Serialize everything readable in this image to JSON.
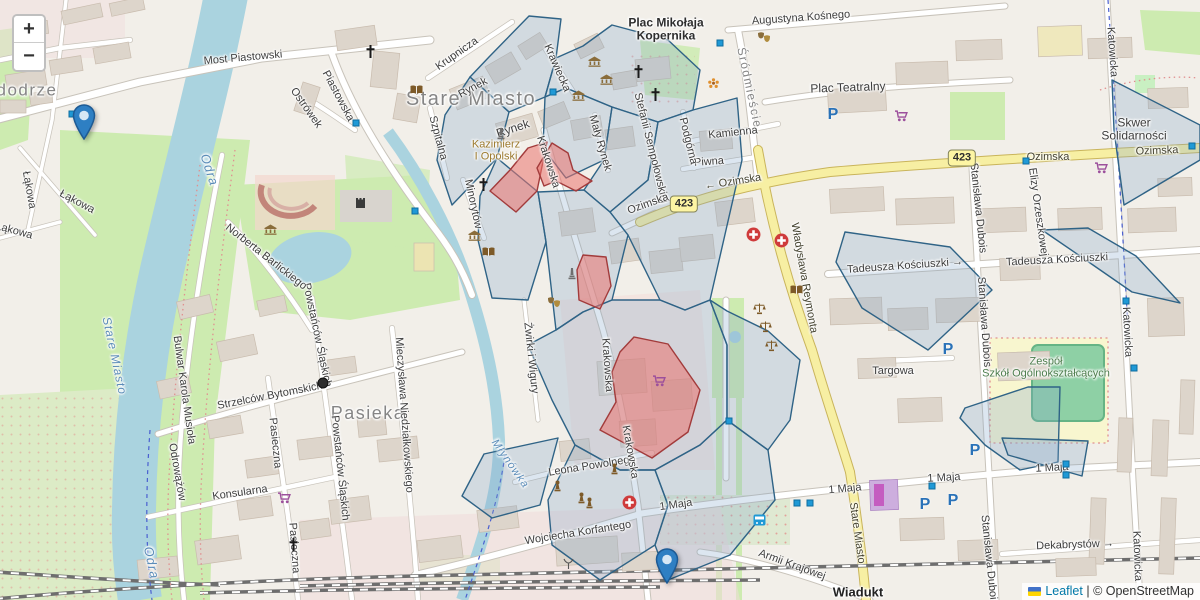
{
  "controls": {
    "zoom_in": "+",
    "zoom_out": "−"
  },
  "attribution": {
    "leaflet": "Leaflet",
    "separator": " | ",
    "copyright": "© OpenStreetMap"
  },
  "glyphs": {
    "parking": "P"
  },
  "colors": {
    "land": "#f2efe9",
    "water": "#aad3df",
    "green": "#cdebb0",
    "building": "#ddd5cb",
    "road_major": "#f7efa3",
    "overlay_blue_stroke": "#2f6386",
    "overlay_blue_fill": "rgba(130,165,200,0.28)",
    "overlay_red_stroke": "#a23b3b",
    "overlay_red_fill": "rgba(235,115,110,0.55)",
    "marker_blue": "#2e7fc3",
    "leaflet_link": "#0078a8"
  },
  "badges": [
    {
      "t": "423",
      "x": 684,
      "y": 204
    },
    {
      "t": "423",
      "x": 962,
      "y": 158
    }
  ],
  "labels": [
    {
      "t": "dodrze",
      "x": 27,
      "y": 90,
      "r": 0,
      "cls": "district",
      "fs": 17
    },
    {
      "t": "Most Piastowski",
      "x": 243,
      "y": 58,
      "r": -5
    },
    {
      "t": "Piastowska",
      "x": 338,
      "y": 96,
      "r": 62
    },
    {
      "t": "Ostrówek",
      "x": 306,
      "y": 108,
      "r": 55
    },
    {
      "t": "Odra",
      "x": 209,
      "y": 170,
      "r": 72,
      "cls": "water",
      "fs": 13
    },
    {
      "t": "Odra",
      "x": 151,
      "y": 563,
      "r": 78,
      "cls": "water",
      "fs": 13
    },
    {
      "t": "Stare Miasto",
      "x": 471,
      "y": 99,
      "r": 0,
      "cls": "district",
      "fs": 20
    },
    {
      "t": "Stare Miasto",
      "x": 114,
      "y": 356,
      "r": 78,
      "cls": "water",
      "fs": 12
    },
    {
      "t": "Krupnicza",
      "x": 457,
      "y": 54,
      "r": -35
    },
    {
      "t": "Rynek",
      "x": 473,
      "y": 88,
      "r": -28
    },
    {
      "t": "Rynek",
      "x": 513,
      "y": 129,
      "r": -18,
      "fs": 12
    },
    {
      "t": "Szpitalna",
      "x": 438,
      "y": 138,
      "r": 75
    },
    {
      "t": "Kazimierz\nI Opolski",
      "x": 496,
      "y": 151,
      "r": 0,
      "cls": "gold"
    },
    {
      "t": "Krawiecka",
      "x": 557,
      "y": 68,
      "r": 66
    },
    {
      "t": "Mały Rynek",
      "x": 600,
      "y": 143,
      "r": 74
    },
    {
      "t": "Stefanii Sempołowskiej",
      "x": 651,
      "y": 148,
      "r": 76
    },
    {
      "t": "Plac Mikołaja\nKopernika",
      "x": 666,
      "y": 30,
      "r": 0,
      "cls": "place",
      "fs": 12
    },
    {
      "t": "Śródmieście",
      "x": 749,
      "y": 88,
      "r": 78,
      "cls": "district",
      "fs": 12
    },
    {
      "t": "Augustyna Kośnego",
      "x": 801,
      "y": 18,
      "r": -4
    },
    {
      "t": "Plac Teatralny",
      "x": 848,
      "y": 88,
      "r": -2,
      "fs": 12
    },
    {
      "t": "Kamienna",
      "x": 733,
      "y": 133,
      "r": -6
    },
    {
      "t": "Piwna",
      "x": 709,
      "y": 162,
      "r": -4
    },
    {
      "t": "Podgórna",
      "x": 688,
      "y": 141,
      "r": 76
    },
    {
      "t": "← Ozimska",
      "x": 733,
      "y": 182,
      "r": -9,
      "cls": "road"
    },
    {
      "t": "Ozimska",
      "x": 648,
      "y": 204,
      "r": -20
    },
    {
      "t": "Ozimska",
      "x": 1048,
      "y": 157,
      "r": 0,
      "cls": "road"
    },
    {
      "t": "Ozimska",
      "x": 1157,
      "y": 151,
      "r": -2,
      "cls": "road"
    },
    {
      "t": "Skwer Solidarności",
      "x": 1134,
      "y": 130,
      "r": 0,
      "fs": 12
    },
    {
      "t": "Elizy Orzeszkowej",
      "x": 1038,
      "y": 212,
      "r": 82
    },
    {
      "t": "Stanisława Dubois",
      "x": 978,
      "y": 208,
      "r": 84
    },
    {
      "t": "Stanisława Dubois",
      "x": 984,
      "y": 322,
      "r": 86
    },
    {
      "t": "Stanisława Dubois",
      "x": 989,
      "y": 560,
      "r": 84
    },
    {
      "t": "Tadeusza Kościuszki →",
      "x": 905,
      "y": 266,
      "r": -4
    },
    {
      "t": "Tadeusza Kościuszki",
      "x": 1057,
      "y": 260,
      "r": -3
    },
    {
      "t": "Władysława Reymonta",
      "x": 804,
      "y": 278,
      "r": 80,
      "cls": "road"
    },
    {
      "t": "Targowa",
      "x": 893,
      "y": 371,
      "r": 0
    },
    {
      "t": "Katowicka",
      "x": 1112,
      "y": 52,
      "r": 86
    },
    {
      "t": "Katowicka",
      "x": 1127,
      "y": 332,
      "r": 87
    },
    {
      "t": "Katowicka",
      "x": 1137,
      "y": 556,
      "r": 88
    },
    {
      "t": "Zespół\nSzkół Ogólnokształcących",
      "x": 1046,
      "y": 368,
      "r": 0,
      "cls": "school"
    },
    {
      "t": "1 Maja",
      "x": 676,
      "y": 505,
      "r": -8
    },
    {
      "t": "1 Maja",
      "x": 845,
      "y": 489,
      "r": -5
    },
    {
      "t": "1 Maja",
      "x": 944,
      "y": 478,
      "r": -3
    },
    {
      "t": "1 Maja",
      "x": 1052,
      "y": 468,
      "r": -3
    },
    {
      "t": "Leona Powolnego",
      "x": 592,
      "y": 466,
      "r": -9
    },
    {
      "t": "Wojciecha Korfantego",
      "x": 578,
      "y": 533,
      "r": -9
    },
    {
      "t": "Armii Krajowej",
      "x": 792,
      "y": 565,
      "r": 20
    },
    {
      "t": "Wiadukt",
      "x": 858,
      "y": 593,
      "r": 0,
      "cls": "bold-dark",
      "fs": 13
    },
    {
      "t": "Dekabrystów →",
      "x": 1075,
      "y": 545,
      "r": -2
    },
    {
      "t": "Stare Miasto",
      "x": 857,
      "y": 533,
      "r": 82,
      "cls": "road"
    },
    {
      "t": "Krakowska",
      "x": 548,
      "y": 162,
      "r": 72
    },
    {
      "t": "Krakowska",
      "x": 607,
      "y": 365,
      "r": 86
    },
    {
      "t": "Krakowska",
      "x": 630,
      "y": 452,
      "r": 80
    },
    {
      "t": "Żwirki i Wigury",
      "x": 531,
      "y": 358,
      "r": 84
    },
    {
      "t": "Młynówka",
      "x": 510,
      "y": 464,
      "r": 55,
      "cls": "water"
    },
    {
      "t": "Łąkowa",
      "x": 29,
      "y": 190,
      "r": 80
    },
    {
      "t": "Łąkowa",
      "x": 77,
      "y": 202,
      "r": 28
    },
    {
      "t": "Łąkowa",
      "x": 14,
      "y": 231,
      "r": 15
    },
    {
      "t": "Konsularna",
      "x": 240,
      "y": 493,
      "r": -8
    },
    {
      "t": "Strzelców Bytomskich",
      "x": 270,
      "y": 396,
      "r": -11
    },
    {
      "t": "Pasieka",
      "x": 368,
      "y": 413,
      "r": 0,
      "cls": "district",
      "fs": 18
    },
    {
      "t": "Pasieczna",
      "x": 275,
      "y": 443,
      "r": 84
    },
    {
      "t": "Pasieczna",
      "x": 294,
      "y": 548,
      "r": 86
    },
    {
      "t": "Powstańców Śląskich",
      "x": 317,
      "y": 335,
      "r": 78
    },
    {
      "t": "Powstańców Śląskich",
      "x": 340,
      "y": 468,
      "r": 84
    },
    {
      "t": "Mieczysława Niedziałkowskiego",
      "x": 404,
      "y": 415,
      "r": 86
    },
    {
      "t": "Norberta Barlickiego",
      "x": 266,
      "y": 257,
      "r": 38
    },
    {
      "t": "Bulwar Karola Musioła",
      "x": 184,
      "y": 390,
      "r": 82
    },
    {
      "t": "Odrowążów",
      "x": 177,
      "y": 472,
      "r": 80
    },
    {
      "t": "Minorytów",
      "x": 473,
      "y": 204,
      "r": 78
    }
  ],
  "icons": [
    {
      "k": "bus",
      "x": 72,
      "y": 114
    },
    {
      "k": "bus",
      "x": 356,
      "y": 123
    },
    {
      "k": "bus",
      "x": 720,
      "y": 43
    },
    {
      "k": "bus",
      "x": 553,
      "y": 92
    },
    {
      "k": "bus",
      "x": 1026,
      "y": 161
    },
    {
      "k": "bus",
      "x": 1192,
      "y": 146
    },
    {
      "k": "bus",
      "x": 415,
      "y": 211
    },
    {
      "k": "bus",
      "x": 729,
      "y": 421
    },
    {
      "k": "bus",
      "x": 932,
      "y": 486
    },
    {
      "k": "bus",
      "x": 1066,
      "y": 464
    },
    {
      "k": "bus",
      "x": 1066,
      "y": 475
    },
    {
      "k": "bus",
      "x": 1134,
      "y": 368
    },
    {
      "k": "bus",
      "x": 1126,
      "y": 301
    },
    {
      "k": "bus",
      "x": 797,
      "y": 503
    },
    {
      "k": "bus",
      "x": 810,
      "y": 503
    },
    {
      "k": "parking",
      "x": 833,
      "y": 115
    },
    {
      "k": "parking",
      "x": 948,
      "y": 350
    },
    {
      "k": "parking",
      "x": 975,
      "y": 451
    },
    {
      "k": "parking",
      "x": 925,
      "y": 505
    },
    {
      "k": "parking",
      "x": 953,
      "y": 501
    },
    {
      "k": "cart",
      "x": 895,
      "y": 110
    },
    {
      "k": "cart",
      "x": 1095,
      "y": 162
    },
    {
      "k": "cart",
      "x": 653,
      "y": 375
    },
    {
      "k": "cart",
      "x": 278,
      "y": 492
    },
    {
      "k": "medical",
      "x": 746,
      "y": 227
    },
    {
      "k": "medical",
      "x": 774,
      "y": 233
    },
    {
      "k": "medical",
      "x": 622,
      "y": 495
    },
    {
      "k": "church",
      "x": 365,
      "y": 45
    },
    {
      "k": "church",
      "x": 633,
      "y": 65
    },
    {
      "k": "church",
      "x": 650,
      "y": 88
    },
    {
      "k": "church",
      "x": 478,
      "y": 178
    },
    {
      "k": "church",
      "x": 288,
      "y": 538
    },
    {
      "k": "museum",
      "x": 588,
      "y": 56
    },
    {
      "k": "museum",
      "x": 600,
      "y": 74
    },
    {
      "k": "museum",
      "x": 572,
      "y": 90
    },
    {
      "k": "museum",
      "x": 468,
      "y": 230
    },
    {
      "k": "museum",
      "x": 264,
      "y": 224
    },
    {
      "k": "book",
      "x": 410,
      "y": 85
    },
    {
      "k": "book",
      "x": 482,
      "y": 247
    },
    {
      "k": "book",
      "x": 790,
      "y": 285
    },
    {
      "k": "theater",
      "x": 757,
      "y": 32
    },
    {
      "k": "theater",
      "x": 547,
      "y": 297
    },
    {
      "k": "scales",
      "x": 753,
      "y": 303
    },
    {
      "k": "scales",
      "x": 759,
      "y": 321
    },
    {
      "k": "scales",
      "x": 765,
      "y": 340
    },
    {
      "k": "castle",
      "x": 355,
      "y": 196
    },
    {
      "k": "obelisk",
      "x": 568,
      "y": 267
    },
    {
      "k": "obelisk",
      "x": 497,
      "y": 127
    },
    {
      "k": "pawn",
      "x": 553,
      "y": 480
    },
    {
      "k": "pawn",
      "x": 610,
      "y": 463
    },
    {
      "k": "pawn",
      "x": 577,
      "y": 492
    },
    {
      "k": "pawn",
      "x": 585,
      "y": 497
    },
    {
      "k": "flower",
      "x": 708,
      "y": 78
    },
    {
      "k": "antenna",
      "x": 563,
      "y": 558
    },
    {
      "k": "tram",
      "x": 753,
      "y": 514
    },
    {
      "k": "dot",
      "x": 323,
      "y": 383
    }
  ],
  "markers": [
    {
      "x": 72,
      "y": 104
    },
    {
      "x": 655,
      "y": 548
    }
  ],
  "overlay": {
    "blue_polygons": [
      [
        [
          489,
          57
        ],
        [
          529,
          16
        ],
        [
          561,
          19
        ],
        [
          556,
          58
        ],
        [
          545,
          97
        ],
        [
          509,
          112
        ],
        [
          470,
          77
        ]
      ],
      [
        [
          470,
          77
        ],
        [
          509,
          112
        ],
        [
          497,
          158
        ],
        [
          452,
          205
        ],
        [
          437,
          160
        ],
        [
          445,
          115
        ]
      ],
      [
        [
          497,
          158
        ],
        [
          538,
          192
        ],
        [
          546,
          242
        ],
        [
          528,
          300
        ],
        [
          492,
          298
        ],
        [
          478,
          240
        ],
        [
          480,
          196
        ]
      ],
      [
        [
          556,
          58
        ],
        [
          583,
          46
        ],
        [
          612,
          25
        ],
        [
          668,
          40
        ],
        [
          700,
          70
        ],
        [
          693,
          110
        ],
        [
          658,
          122
        ],
        [
          612,
          107
        ],
        [
          566,
          88
        ],
        [
          545,
          97
        ]
      ],
      [
        [
          566,
          88
        ],
        [
          612,
          107
        ],
        [
          604,
          160
        ],
        [
          566,
          178
        ],
        [
          543,
          148
        ],
        [
          545,
          97
        ]
      ],
      [
        [
          612,
          107
        ],
        [
          658,
          122
        ],
        [
          648,
          180
        ],
        [
          610,
          212
        ],
        [
          584,
          190
        ],
        [
          604,
          160
        ]
      ],
      [
        [
          658,
          122
        ],
        [
          693,
          110
        ],
        [
          737,
          98
        ],
        [
          742,
          160
        ],
        [
          710,
          300
        ],
        [
          685,
          310
        ],
        [
          660,
          300
        ],
        [
          628,
          235
        ],
        [
          610,
          212
        ],
        [
          648,
          180
        ]
      ],
      [
        [
          584,
          190
        ],
        [
          610,
          212
        ],
        [
          628,
          235
        ],
        [
          612,
          300
        ],
        [
          583,
          312
        ],
        [
          556,
          330
        ],
        [
          546,
          242
        ],
        [
          538,
          192
        ]
      ],
      [
        [
          556,
          330
        ],
        [
          583,
          312
        ],
        [
          612,
          300
        ],
        [
          660,
          300
        ],
        [
          685,
          310
        ],
        [
          710,
          300
        ],
        [
          727,
          345
        ],
        [
          727,
          420
        ],
        [
          700,
          445
        ],
        [
          655,
          470
        ],
        [
          620,
          470
        ],
        [
          575,
          445
        ],
        [
          552,
          400
        ],
        [
          528,
          345
        ]
      ],
      [
        [
          484,
          454
        ],
        [
          558,
          438
        ],
        [
          540,
          505
        ],
        [
          492,
          518
        ],
        [
          462,
          496
        ]
      ],
      [
        [
          575,
          445
        ],
        [
          620,
          470
        ],
        [
          655,
          470
        ],
        [
          668,
          505
        ],
        [
          655,
          545
        ],
        [
          600,
          580
        ],
        [
          552,
          545
        ],
        [
          548,
          500
        ]
      ],
      [
        [
          655,
          470
        ],
        [
          700,
          445
        ],
        [
          727,
          420
        ],
        [
          768,
          450
        ],
        [
          775,
          500
        ],
        [
          730,
          555
        ],
        [
          668,
          580
        ],
        [
          655,
          545
        ],
        [
          668,
          505
        ]
      ],
      [
        [
          710,
          300
        ],
        [
          727,
          311
        ],
        [
          768,
          331
        ],
        [
          800,
          360
        ],
        [
          790,
          420
        ],
        [
          768,
          450
        ],
        [
          727,
          420
        ],
        [
          727,
          345
        ]
      ],
      [
        [
          845,
          232
        ],
        [
          950,
          247
        ],
        [
          992,
          290
        ],
        [
          928,
          350
        ],
        [
          862,
          308
        ],
        [
          836,
          262
        ]
      ],
      [
        [
          1042,
          230
        ],
        [
          1080,
          256
        ],
        [
          1132,
          292
        ],
        [
          1180,
          303
        ],
        [
          1136,
          256
        ],
        [
          1088,
          228
        ]
      ],
      [
        [
          1112,
          80
        ],
        [
          1200,
          125
        ],
        [
          1200,
          160
        ],
        [
          1124,
          205
        ],
        [
          1114,
          130
        ]
      ],
      [
        [
          965,
          408
        ],
        [
          1028,
          387
        ],
        [
          1060,
          387
        ],
        [
          1058,
          462
        ],
        [
          1020,
          470
        ],
        [
          985,
          445
        ],
        [
          960,
          418
        ]
      ],
      [
        [
          1002,
          438
        ],
        [
          1088,
          441
        ],
        [
          1082,
          476
        ],
        [
          1008,
          455
        ]
      ]
    ],
    "red_polygons": [
      [
        [
          490,
          191
        ],
        [
          516,
          212
        ],
        [
          537,
          191
        ],
        [
          547,
          142
        ],
        [
          528,
          148
        ],
        [
          510,
          170
        ]
      ],
      [
        [
          537,
          168
        ],
        [
          552,
          143
        ],
        [
          568,
          153
        ],
        [
          573,
          170
        ],
        [
          592,
          181
        ],
        [
          576,
          191
        ],
        [
          556,
          181
        ],
        [
          544,
          186
        ]
      ],
      [
        [
          583,
          255
        ],
        [
          606,
          257
        ],
        [
          611,
          286
        ],
        [
          600,
          309
        ],
        [
          579,
          300
        ],
        [
          577,
          270
        ]
      ],
      [
        [
          620,
          352
        ],
        [
          634,
          337
        ],
        [
          668,
          344
        ],
        [
          700,
          390
        ],
        [
          688,
          432
        ],
        [
          652,
          458
        ],
        [
          600,
          430
        ],
        [
          616,
          402
        ],
        [
          612,
          372
        ]
      ]
    ]
  }
}
